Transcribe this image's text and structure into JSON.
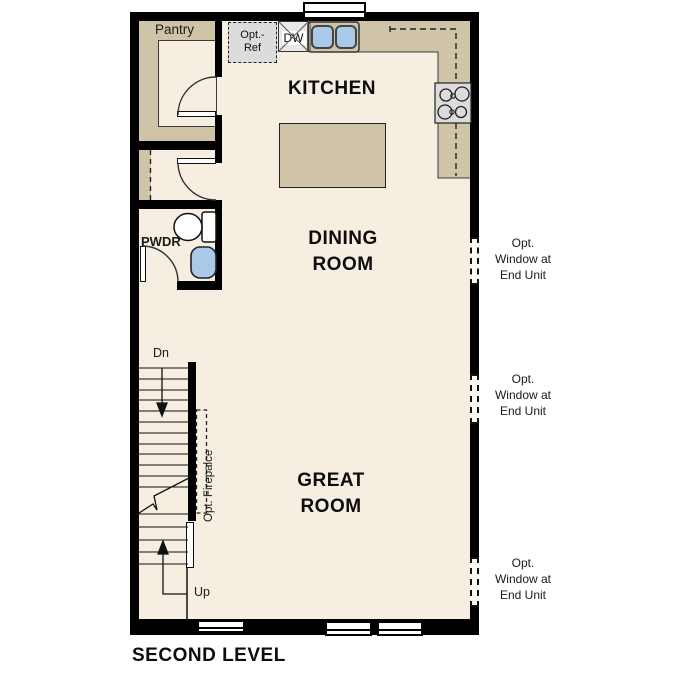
{
  "page_title": "SECOND LEVEL",
  "floor_plan": {
    "rooms": {
      "kitchen": "KITCHEN",
      "dining_line1": "DINING",
      "dining_line2": "ROOM",
      "great_line1": "GREAT",
      "great_line2": "ROOM",
      "pantry": "Pantry",
      "powder": "PWDR"
    },
    "stairs": {
      "down": "Dn",
      "up": "Up"
    },
    "fixtures": {
      "dishwasher": "DW",
      "opt_ref_line1": "Opt.-",
      "opt_ref_line2": "Ref",
      "opt_fireplace": "Opt. Firepalce"
    },
    "window_note": {
      "line1": "Opt.",
      "line2": "Window at",
      "line3": "End Unit"
    }
  },
  "colors": {
    "wall": "#000000",
    "floor": "#f6efe1",
    "counter": "#cfc3a8",
    "appliance_gray": "#dcdcdc",
    "sink_blue": "#aac9e8",
    "background": "#ffffff"
  }
}
